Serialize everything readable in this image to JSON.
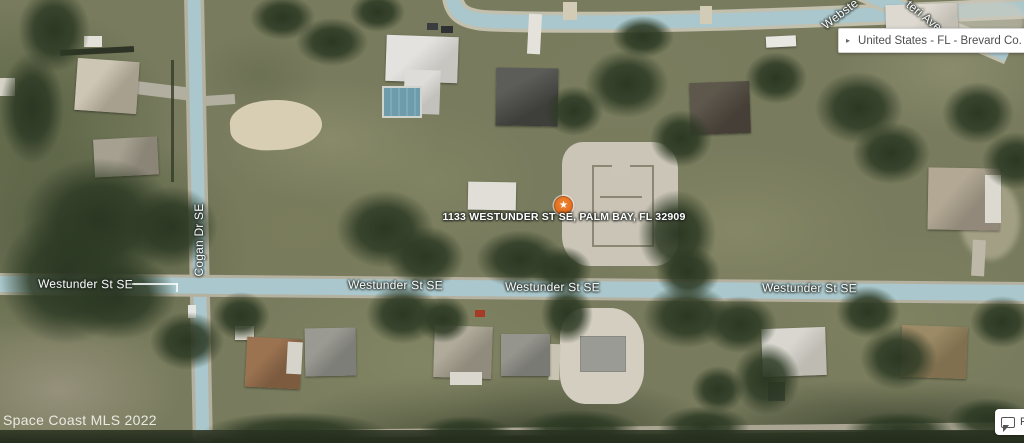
{
  "map": {
    "marker": {
      "address_label": "1133 WESTUNDER ST SE, PALM BAY, FL 32909",
      "star_glyph": "★",
      "color": "#df6a1d"
    },
    "street_labels": {
      "westunder": "Westunder St SE",
      "cogan": "Cogan Dr SE",
      "webster_partial": "Webste",
      "teri_ave_partial": "teri Ave"
    },
    "watermark": "Space Coast MLS 2022"
  },
  "breadcrumb": {
    "collapse_icon": "▸",
    "path_text": "United States - FL - Brevard Co. - Palm B"
  },
  "feedback_button": {
    "label_partial": "Fe"
  },
  "colors": {
    "road": "#a9c7cc",
    "road_shoulder": "#bdb9a8",
    "marker_orange": "#df6a1d",
    "dirt_lot": "#cbc5b7"
  }
}
